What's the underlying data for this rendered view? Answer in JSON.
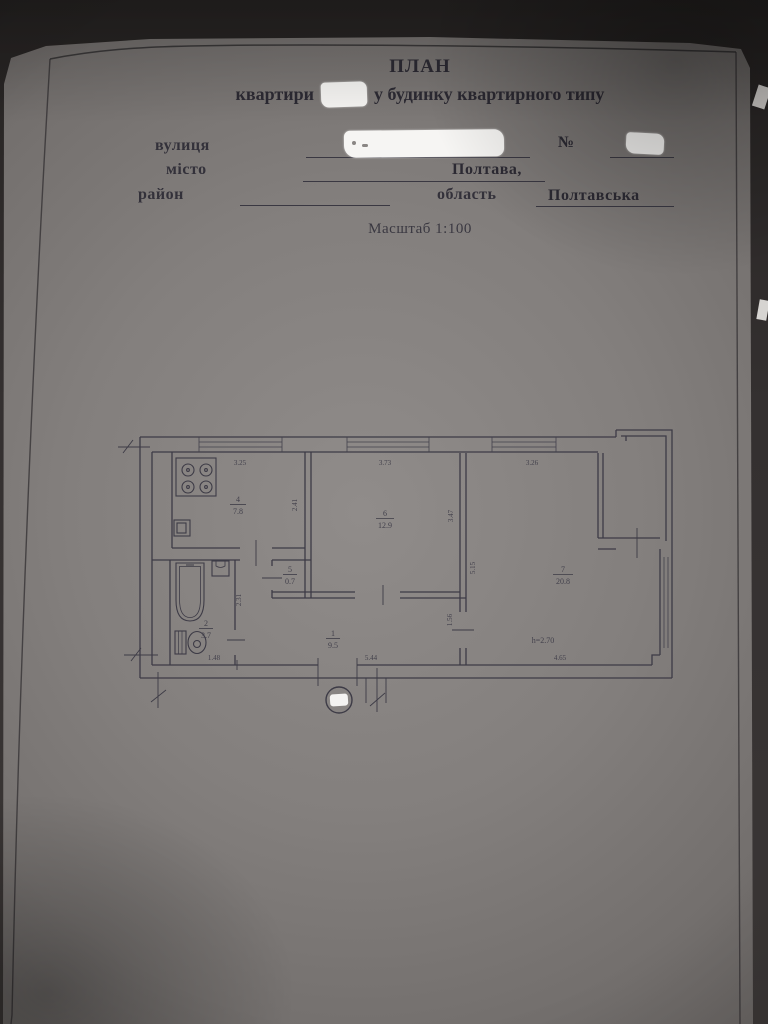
{
  "document": {
    "title": "ПЛАН",
    "subtitle_prefix": "квартири",
    "subtitle_suffix": "у будинку квартирного типу",
    "fields": {
      "street_label": "вулиця",
      "number_label": "№",
      "city_label": "місто",
      "city_value": "Полтава,",
      "district_label": "район",
      "oblast_label": "область",
      "oblast_value": "Полтавська"
    },
    "scale_note": "Масштаб 1:100"
  },
  "plan": {
    "rooms": [
      {
        "number": "1",
        "area": "9.5"
      },
      {
        "number": "2",
        "area": "3.7"
      },
      {
        "number": "4",
        "area": "7.8"
      },
      {
        "number": "5",
        "area": "0.7"
      },
      {
        "number": "6",
        "area": "12.9"
      },
      {
        "number": "7",
        "area": "20.8"
      }
    ],
    "dimensions": {
      "kitchen_width": "3.25",
      "kitchen_depth": "2.41",
      "room6_width": "3.73",
      "room6_depth": "3.47",
      "room7_nook_width": "3.26",
      "room7_depth": "5.15",
      "room7_width": "4.65",
      "bath_depth": "2.31",
      "bath_width": "1.48",
      "hall_width": "5.44",
      "door_wall": "1.56",
      "ceiling_height": "h=2.70"
    }
  }
}
